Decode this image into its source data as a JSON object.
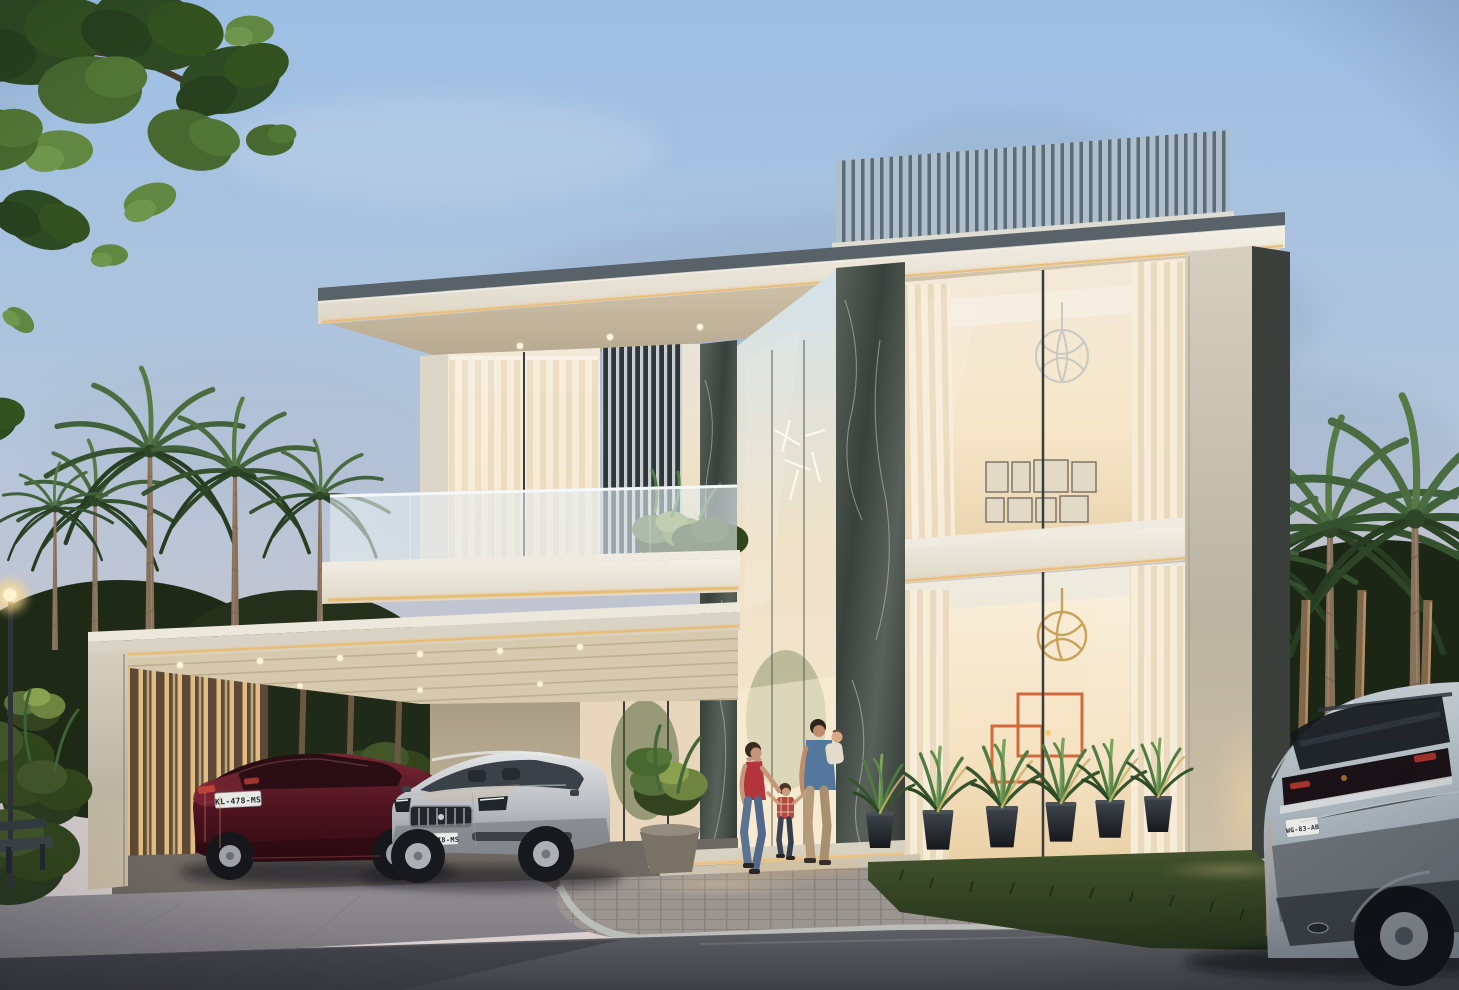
{
  "scene": {
    "title": "Modern two-storey luxury villa at dusk",
    "type": "3D architectural exterior rendering",
    "time_of_day": "dusk",
    "weather": "partly cloudy"
  },
  "palette": {
    "sky_top": "#9DBFE4",
    "sky_horizon": "#DCD2D0",
    "roof_fascia": "#F0EAE0",
    "led_accent": "#EFC27F",
    "rooftop_louver": "#AEBECB",
    "marble": "#39413C",
    "window_glow": "#F6E7C9",
    "carport_slat": "#C9A878",
    "grass": "#2A371E",
    "asphalt": "#4A4B51",
    "paver": "#9B9592",
    "concrete_pillar": "#C6BEAD"
  },
  "building": {
    "storeys": 2,
    "features": [
      "rooftop louver screen",
      "cantilevered flat roof with LED strip",
      "frosted glass balcony",
      "dark marble clad columns",
      "double-height glass entrance",
      "backlit slat carport",
      "floor-to-ceiling glazing with sheer curtains"
    ],
    "interior": {
      "upper_room": {
        "pendant": "silver wire sphere chandelier",
        "wall_decor": "gallery wall of framed prints",
        "frame_count": 8
      },
      "lower_room": {
        "pendant": "gold wire sphere pendant",
        "wall_decor": "orange geometric line art with candle"
      },
      "entry": {
        "pendant": "cluster of white stick lights"
      }
    }
  },
  "vehicles": [
    {
      "name": "maroon sedan",
      "position": "carport left",
      "view": "rear three-quarter",
      "color": "#4E1420",
      "plate": "KL-478-MS"
    },
    {
      "name": "silver sedan",
      "position": "carport right",
      "view": "front three-quarter",
      "color": "#B9BCC0",
      "plate": "KL-478-MS"
    },
    {
      "name": "grey SUV",
      "position": "street right, partially cropped",
      "view": "rear",
      "color": "#A5AFB7",
      "plate": "WG-83-AB"
    }
  ],
  "people": [
    {
      "name": "woman",
      "detail": "red top and jeans, walking toward entrance"
    },
    {
      "name": "child",
      "detail": "red plaid shirt, holding hands between adults"
    },
    {
      "name": "man",
      "detail": "blue shirt and beige trousers, carrying a baby"
    },
    {
      "name": "baby",
      "detail": "carried on the man's arm"
    }
  ],
  "vegetation": {
    "overhanging_tree": "top-left foreground branch",
    "palms_left": 5,
    "palms_right": 4,
    "potted_agaves_front": 6,
    "entry_planter": "round stone pot with shrub",
    "balcony_planting": true,
    "hedges": "dark tropical undergrowth with uplights"
  },
  "street": {
    "lamp": "glowing street lamp, far left",
    "bench": "dark bench silhouette, bottom left",
    "surfaces": [
      "asphalt road",
      "stone paver walkway",
      "concrete driveway",
      "lawn strip"
    ]
  }
}
